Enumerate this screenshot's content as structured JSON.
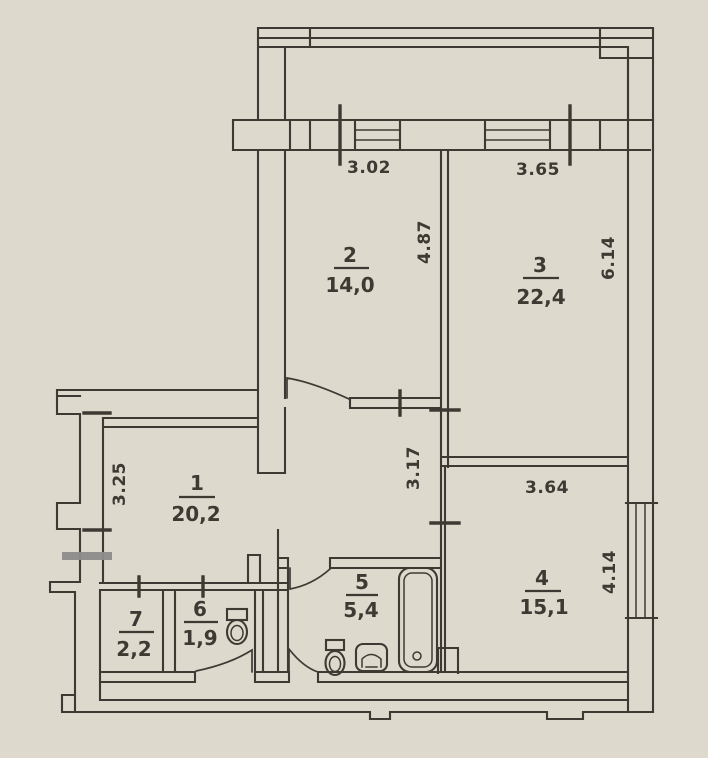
{
  "colors": {
    "paper": "#ddd9cd",
    "ink": "#3d3a33",
    "marker": "#8d8d8b"
  },
  "rooms": [
    {
      "number": "1",
      "area": "20,2"
    },
    {
      "number": "2",
      "area": "14,0"
    },
    {
      "number": "3",
      "area": "22,4"
    },
    {
      "number": "4",
      "area": "15,1"
    },
    {
      "number": "5",
      "area": "5,4"
    },
    {
      "number": "6",
      "area": "1,9"
    },
    {
      "number": "7",
      "area": "2,2"
    }
  ],
  "dimensions": {
    "top_window_left": "3.02",
    "top_window_right": "3.65",
    "room2_depth": "4.87",
    "room3_depth": "6.14",
    "room1_left": "3.25",
    "hall_depth": "3.17",
    "room4_width": "3.64",
    "room4_depth": "4.14"
  },
  "fixtures": [
    "bathtub",
    "toilet",
    "toilet",
    "sink"
  ]
}
